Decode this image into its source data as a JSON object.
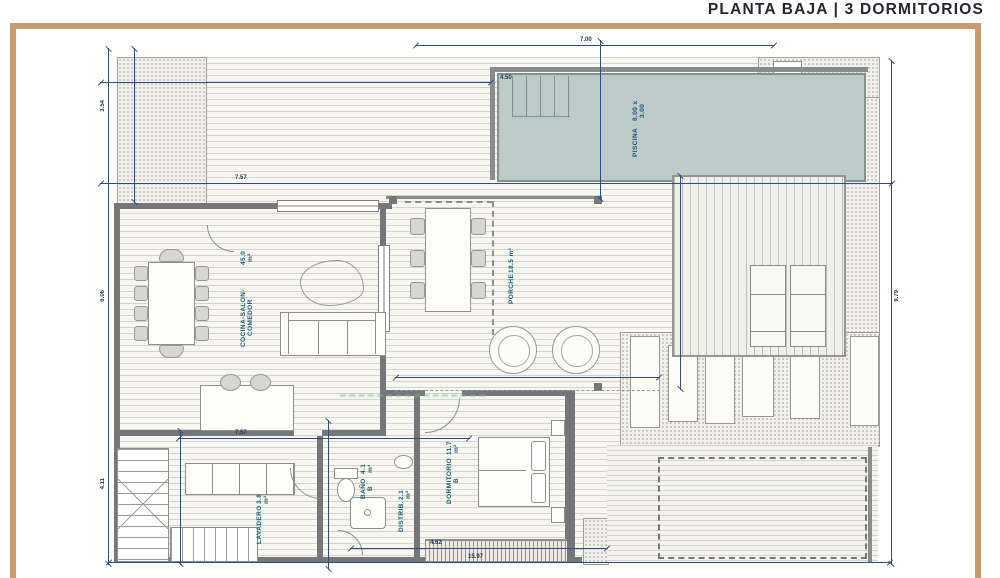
{
  "title": "PLANTA BAJA | 3 DORMITORIOS",
  "rooms": [
    {
      "label": "COCINA-SALON-COMEDOR",
      "area": "45.0 m²"
    },
    {
      "label": "PORCHE",
      "area": "18.5 m²"
    },
    {
      "label": "PISCINA",
      "area": "8.00 x 3.00"
    },
    {
      "label": "DORMITORIO B",
      "area": "11.7 m²"
    },
    {
      "label": "BAÑO B",
      "area": "4.1 m²"
    },
    {
      "label": "DISTRIB.",
      "area": "2.1 m²"
    },
    {
      "label": "LAVADERO",
      "area": "3.8 m²"
    }
  ],
  "dims": [
    "3.54",
    "6.06",
    "4.11",
    "7.57",
    "7.00",
    "7.57",
    "4.62",
    "15.97",
    "9.79",
    "4.50"
  ],
  "colors": {
    "frame": "#c69c6e",
    "dimension_line": "#2f4d7c",
    "pool_fill": "#bccbc8",
    "wall": "#75767a",
    "room_label": "#175d72"
  }
}
